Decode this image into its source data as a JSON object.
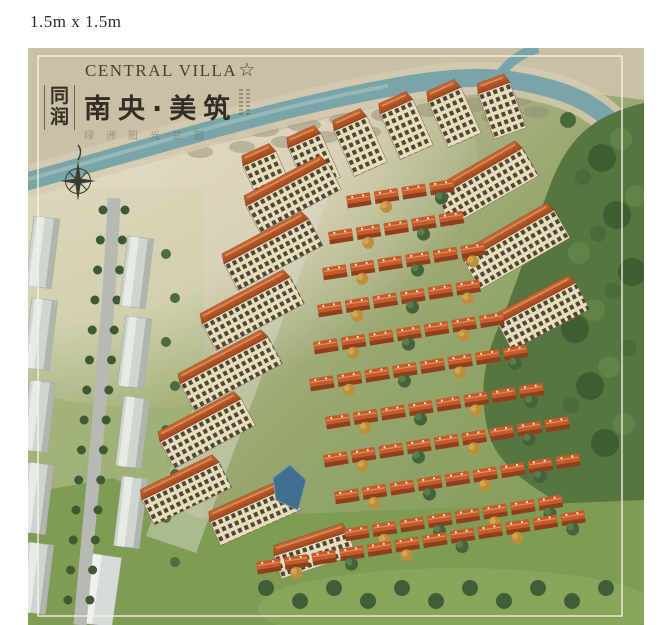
{
  "page": {
    "size_label": "1.5m x 1.5m"
  },
  "poster": {
    "brand_en": "CENTRAL VILLA",
    "brand_en_star": "☆",
    "brand_cn_vertical": "同润",
    "title_cn": "南央·美筑",
    "subtitle_cn": "绿洲阳光兰园",
    "compass_icon": "compass-rose-icon"
  },
  "colors": {
    "ink": "#3a342a",
    "cream": "#ded6bd",
    "river": "#79a5a9",
    "forest": "#57753f",
    "lawn": "#7e9c53",
    "villa_roof": "#c65a2b",
    "tower_roof": "#c05a2a",
    "tower_facade": "#e7ddba",
    "warehouse": "#cfd6cf",
    "pond": "#41708f"
  },
  "scene": {
    "villa_rows": [
      {
        "x": 318,
        "y": 148,
        "n": 4
      },
      {
        "x": 300,
        "y": 184,
        "n": 5
      },
      {
        "x": 294,
        "y": 220,
        "n": 6
      },
      {
        "x": 289,
        "y": 257,
        "n": 6
      },
      {
        "x": 285,
        "y": 294,
        "n": 7
      },
      {
        "x": 281,
        "y": 331,
        "n": 8
      },
      {
        "x": 297,
        "y": 369,
        "n": 8
      },
      {
        "x": 295,
        "y": 407,
        "n": 9
      },
      {
        "x": 306,
        "y": 444,
        "n": 9
      },
      {
        "x": 316,
        "y": 481,
        "n": 8
      },
      {
        "x": 228,
        "y": 514,
        "n": 12
      }
    ],
    "towers": [
      {
        "x": 215,
        "y": 118,
        "l": 36,
        "h": 46,
        "rot": -24
      },
      {
        "x": 260,
        "y": 100,
        "l": 36,
        "h": 48,
        "rot": -24
      },
      {
        "x": 306,
        "y": 83,
        "l": 36,
        "h": 50,
        "rot": -24
      },
      {
        "x": 352,
        "y": 66,
        "l": 36,
        "h": 50,
        "rot": -24
      },
      {
        "x": 400,
        "y": 54,
        "l": 36,
        "h": 50,
        "rot": -24
      },
      {
        "x": 450,
        "y": 46,
        "l": 34,
        "h": 48,
        "rot": -20
      },
      {
        "x": 218,
        "y": 158,
        "l": 92,
        "h": 30,
        "rot": -28
      },
      {
        "x": 196,
        "y": 216,
        "l": 96,
        "h": 30,
        "rot": -28
      },
      {
        "x": 174,
        "y": 276,
        "l": 100,
        "h": 30,
        "rot": -28
      },
      {
        "x": 152,
        "y": 336,
        "l": 100,
        "h": 30,
        "rot": -28
      },
      {
        "x": 132,
        "y": 394,
        "l": 92,
        "h": 30,
        "rot": -28
      },
      {
        "x": 114,
        "y": 452,
        "l": 86,
        "h": 28,
        "rot": -26
      },
      {
        "x": 408,
        "y": 150,
        "l": 100,
        "h": 32,
        "rot": -30
      },
      {
        "x": 436,
        "y": 214,
        "l": 104,
        "h": 32,
        "rot": -30
      },
      {
        "x": 470,
        "y": 276,
        "l": 88,
        "h": 30,
        "rot": -28
      },
      {
        "x": 182,
        "y": 474,
        "l": 88,
        "h": 26,
        "rot": -24
      },
      {
        "x": 246,
        "y": 508,
        "l": 78,
        "h": 24,
        "rot": -18
      }
    ],
    "warehouses": [
      {
        "x": 6,
        "y": 168
      },
      {
        "x": 4,
        "y": 250
      },
      {
        "x": 2,
        "y": 332
      },
      {
        "x": 0,
        "y": 414
      },
      {
        "x": 0,
        "y": 494
      },
      {
        "x": 100,
        "y": 188
      },
      {
        "x": 98,
        "y": 268
      },
      {
        "x": 96,
        "y": 348
      },
      {
        "x": 94,
        "y": 428
      }
    ]
  }
}
